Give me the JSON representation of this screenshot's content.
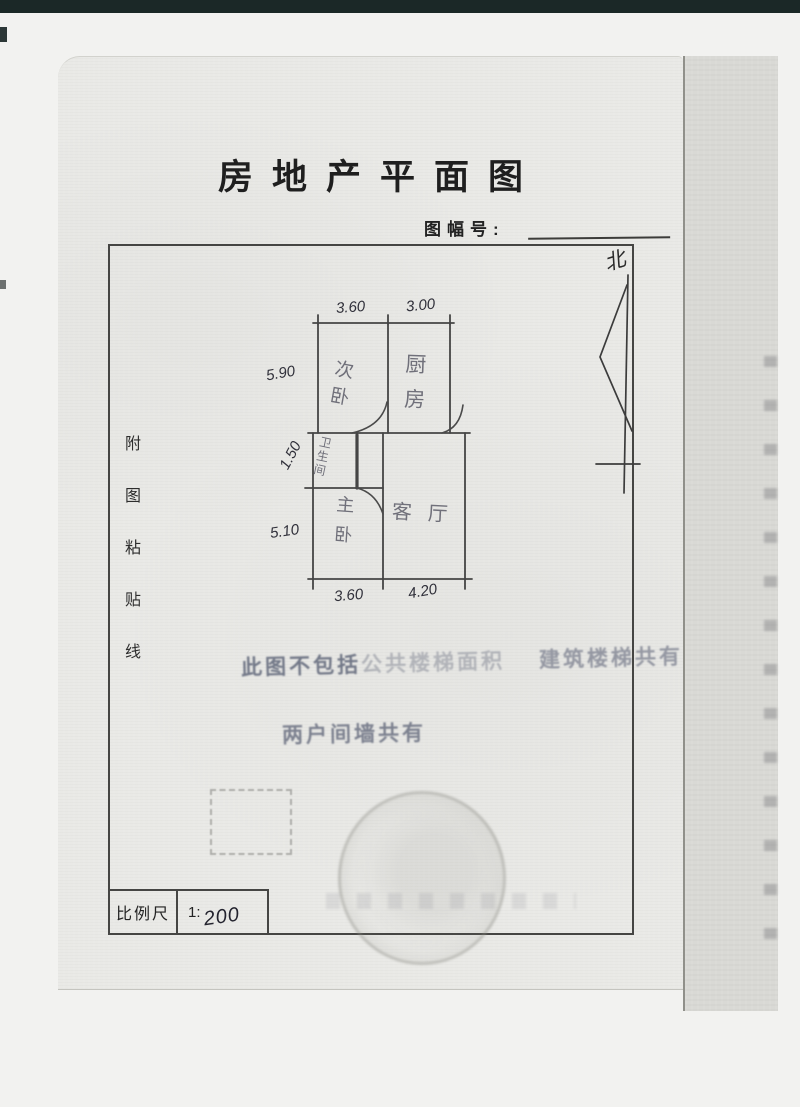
{
  "document": {
    "title": "房地产平面图",
    "sheet_label": "图幅号:",
    "sheet_value": "",
    "paste_line": "附图粘贴线",
    "north": "北",
    "scale": {
      "label": "比例尺",
      "prefix": "1:",
      "value": "200"
    }
  },
  "plan": {
    "rooms": {
      "second_bedroom": "次卧",
      "kitchen": "厨房",
      "bathroom": "卫生间",
      "master_bedroom": "主卧",
      "living_room": "客厅"
    },
    "dimensions": {
      "top_left": "3.60",
      "top_right": "3.00",
      "left_upper": "5.90",
      "left_middle": "1.50",
      "left_lower": "5.10",
      "bottom_left": "3.60",
      "bottom_right": "4.20"
    }
  },
  "stamps": {
    "note1_strong": "此图不包括",
    "note1_faint": "公共楼梯面积",
    "note1_right": "建筑楼梯共有",
    "note2": "两户间墙共有"
  }
}
